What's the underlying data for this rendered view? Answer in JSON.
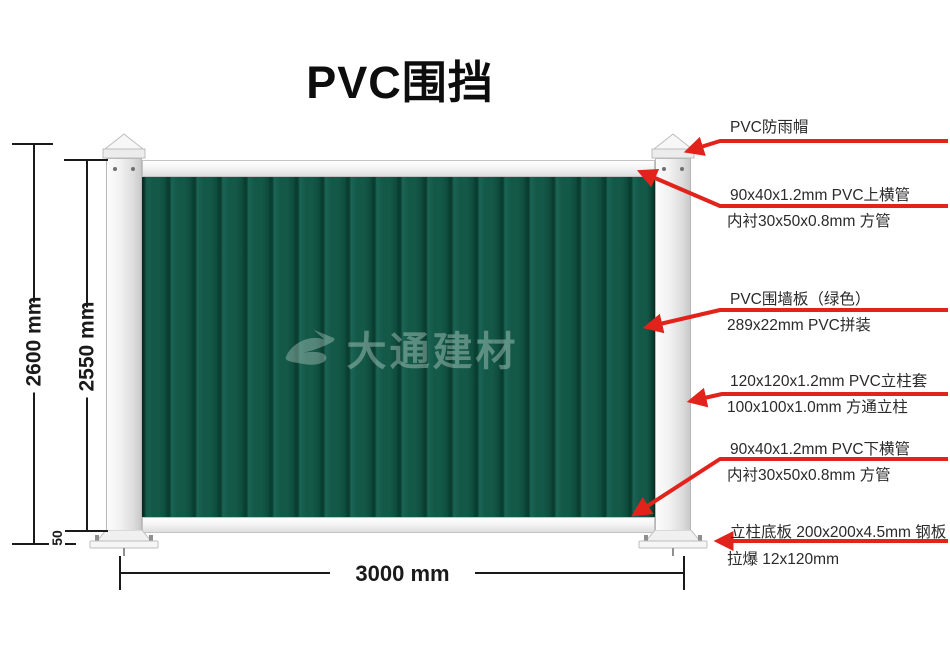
{
  "title": "PVC围挡",
  "watermark": {
    "text": "大通建材",
    "logo": "datong-swoosh-logo"
  },
  "dimensions": {
    "total_height": "2600 mm",
    "panel_height": "2550 mm",
    "ground_gap": "50",
    "width": "3000 mm"
  },
  "callouts": [
    {
      "line1": "PVC防雨帽",
      "line2": ""
    },
    {
      "line1": "90x40x1.2mm PVC上横管",
      "line2": "内衬30x50x0.8mm 方管"
    },
    {
      "line1": "PVC围墙板（绿色）",
      "line2": "289x22mm PVC拼装"
    },
    {
      "line1": "120x120x1.2mm PVC立柱套",
      "line2": "100x100x1.0mm 方通立柱"
    },
    {
      "line1": "90x40x1.2mm PVC下横管",
      "line2": "内衬30x50x0.8mm 方管"
    },
    {
      "line1": "立柱底板 200x200x4.5mm 钢板",
      "line2": "拉爆 12x120mm"
    }
  ],
  "colors": {
    "panel_green": "#145848",
    "panel_seam": "#093e31",
    "arrow_red": "#e2231c",
    "text_black": "#1a1a1a",
    "post_white": "#f1f1f1"
  }
}
